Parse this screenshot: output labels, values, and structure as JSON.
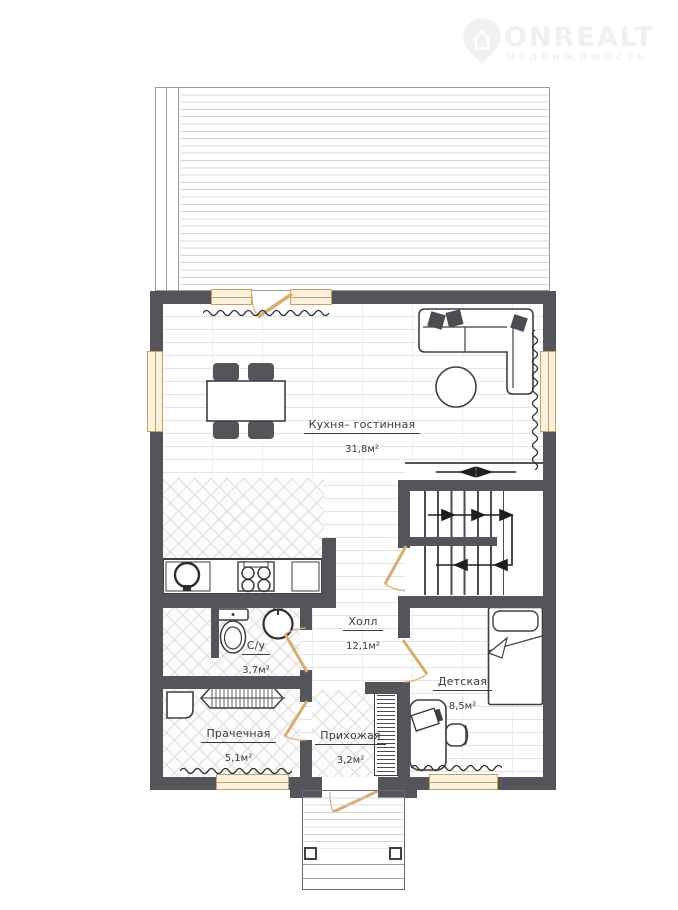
{
  "watermark": {
    "brand": "ONREALT",
    "tagline": "НЕДВИЖИМОСТЬ"
  },
  "rooms": {
    "living": {
      "name": "Кухня– гостинная",
      "area": "31,8м²"
    },
    "hall": {
      "name": "Холл",
      "area": "12,1м²"
    },
    "bathroom": {
      "name": "С/у",
      "area": "3,7м²"
    },
    "kids": {
      "name": "Детская",
      "area": "8,5м²"
    },
    "laundry": {
      "name": "Прачечная",
      "area": "5,1м²"
    },
    "entry": {
      "name": "Прихожая",
      "area": "3,2м²"
    }
  },
  "colors": {
    "wall": "#54545a",
    "joinery": "#d2a76d",
    "floor_line": "#e3e3e3"
  }
}
